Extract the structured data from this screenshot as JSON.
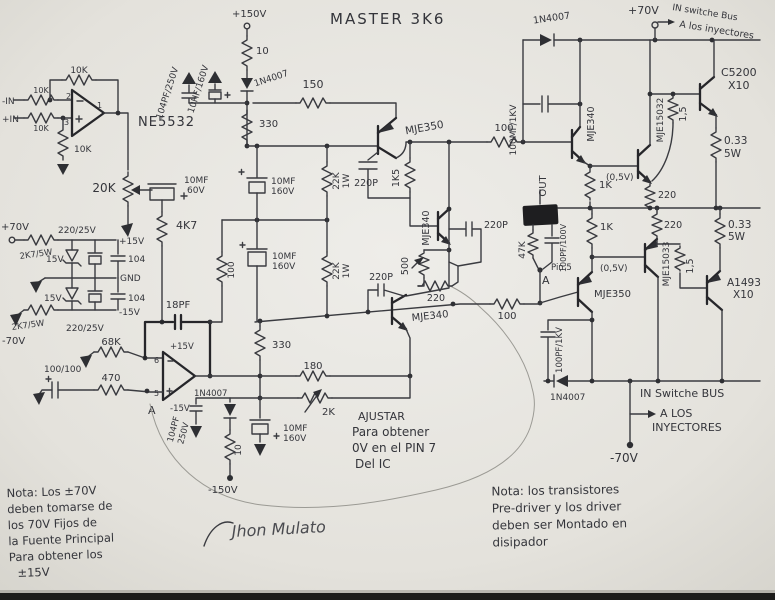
{
  "title": "MASTER 3K6",
  "ic_name": "NE5532",
  "signature": "Jhon Mulato",
  "input_stage": {
    "feedback_res": "10K",
    "in_neg": "-IN",
    "in_neg_res": "10K",
    "in_pos": "+IN",
    "in_pos_res": "10K",
    "gnd_res": "10K",
    "pin_inv": "2",
    "pin_nin": "3",
    "pin_out": "1",
    "pot": "20K",
    "cap": [
      "10MF",
      "60V"
    ],
    "res_4k7": "4K7"
  },
  "psu": {
    "v_pos": "+70V",
    "v_neg": "-70V",
    "res_top": "2K7/5W",
    "res_bot": "2K7/5W",
    "cap_top": "220/25V",
    "cap_bot": "220/25V",
    "zener_top": "15V",
    "zener_bot": "15V",
    "cer_top": "104",
    "cer_bot": "104",
    "rail_pos": "+15V",
    "rail_gnd": "GND",
    "rail_neg": "-15V"
  },
  "vas": {
    "v150_pos": "+150V",
    "res10_top": "10",
    "diode_top": "1N4007",
    "cap_film": "104PF/250V",
    "cap_el": "10HF/160V",
    "res150": "150",
    "res330_top": "330",
    "q_pre": "MJE350",
    "cap220p_a": "220P",
    "cap_a": [
      "10MF",
      "160V"
    ],
    "res22k_a": [
      "22K",
      "1W"
    ],
    "res1k5": "1K5",
    "q_mid": "MJE340",
    "pot500": "500",
    "res220": "220",
    "cap220p_b": "220P",
    "cap_b": [
      "10MF",
      "160V"
    ],
    "res22k_b": [
      "22K",
      "1W"
    ],
    "cap220p_c": "220P",
    "q_low": "MJE340",
    "res330_bot": "330",
    "res180": "180",
    "pot2k": "2K",
    "cap_c": [
      "10MF",
      "160V"
    ],
    "diode_bot": "1N4007",
    "cap_film_b": [
      "104PF",
      "250V"
    ],
    "res10_bot": "10",
    "v150_neg": "-150V"
  },
  "opamp_b": {
    "cap18pf": "18PF",
    "res68k": "68K",
    "v_pos": "+15V",
    "v_neg": "-15V",
    "pin_inv": "6",
    "pin_nin": "5",
    "cap_in": "100/100",
    "res_in": "470",
    "node": "A",
    "fb_res": "100"
  },
  "output_pos": {
    "diode": "1N4007",
    "cap": "100MF/1KV",
    "v70": "+70V",
    "bus": "IN switche Bus",
    "inj": "A los inyectores",
    "res100": "100",
    "q_driver": "MJE340",
    "res1k": "1K",
    "vbe": "(0,5V)",
    "q_pre_final": "MJE15032",
    "res1_5": "1,5",
    "q_final": [
      "C5200",
      "X10"
    ],
    "res033": [
      "0.33",
      "5W"
    ],
    "res220": "220"
  },
  "output_neg": {
    "out": "OUT",
    "res47k": "47K",
    "cap": "100PF/100V",
    "pin": "Pin 5",
    "node": "A",
    "res100": "100",
    "q_driver": "MJE350",
    "res1k": "1K",
    "vbe": "(0,5V)",
    "q_pre_final": "MJE15033",
    "res1_5": "1,5",
    "q_final": [
      "A1493",
      "X10"
    ],
    "res033": [
      "0.33",
      "5W"
    ],
    "res220": "220",
    "cap2": "100PF/1KV",
    "diode": "1N4007",
    "bus": "IN Switche BUS",
    "inj": [
      "A LOS",
      "INYECTORES"
    ],
    "v70": "-70V"
  },
  "notes": {
    "left": [
      "Nota: Los ±70V",
      "deben tomarse de",
      "los 70V Fijos de",
      "la Fuente Principal",
      "Para obtener los",
      "±15V"
    ],
    "adjust": [
      "AJUSTAR",
      "Para obtener",
      "0V en el PIN 7",
      "Del IC"
    ],
    "right": [
      "Nota: los transistores",
      "Pre-driver y los driver",
      "deben ser Montado en",
      "disipador"
    ]
  }
}
